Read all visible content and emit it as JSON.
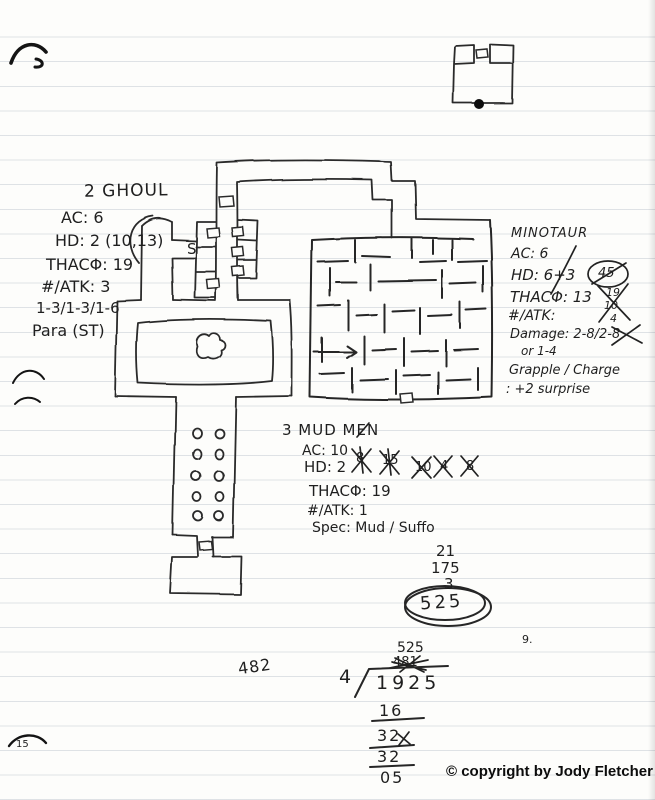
{
  "scan": {
    "page_number": "15"
  },
  "footer": {
    "copyright": "© copyright by Jody Fletcher"
  },
  "map": {
    "secret_door": "S"
  },
  "monsters": {
    "ghoul": {
      "title": "2 GHOUL",
      "ac": "AC: 6",
      "hd": "HD: 2 (10,13)",
      "thac0": "THACΦ: 19",
      "atk": "#/ATK: 3",
      "damage": "1-3/1-3/1-6",
      "special": "Para (ST)"
    },
    "minotaur": {
      "title": "MINOTAUR",
      "ac": "AC: 6",
      "hd": "HD: 6+3",
      "hp_circled": "45",
      "thac0": "THACΦ: 13",
      "atk": "#/ATK:",
      "damage": "Damage: 2-8/2-8",
      "damage2": "or 1-4",
      "special1": "Grapple / Charge",
      "special2": ": +2 surprise",
      "hp_scratch": [
        "19",
        "10",
        "4"
      ]
    },
    "mudmen": {
      "title": "3 MUD MEN",
      "ac": "AC: 10",
      "hd": "HD: 2",
      "thac0": "THACΦ: 19",
      "atk": "#/ATK: 1",
      "special": "Spec: Mud / Suffo",
      "hp_scratch": [
        "8",
        "15",
        "10",
        "4",
        "8"
      ]
    }
  },
  "math": {
    "sum": {
      "addends": [
        "21",
        "175",
        "3"
      ],
      "result": "525"
    },
    "division": {
      "top": "525",
      "scratch": "481",
      "divisor": "4",
      "dividend": "1925",
      "lines": [
        "16",
        "32",
        "32",
        "05"
      ]
    },
    "side": "482",
    "stray": "9."
  }
}
